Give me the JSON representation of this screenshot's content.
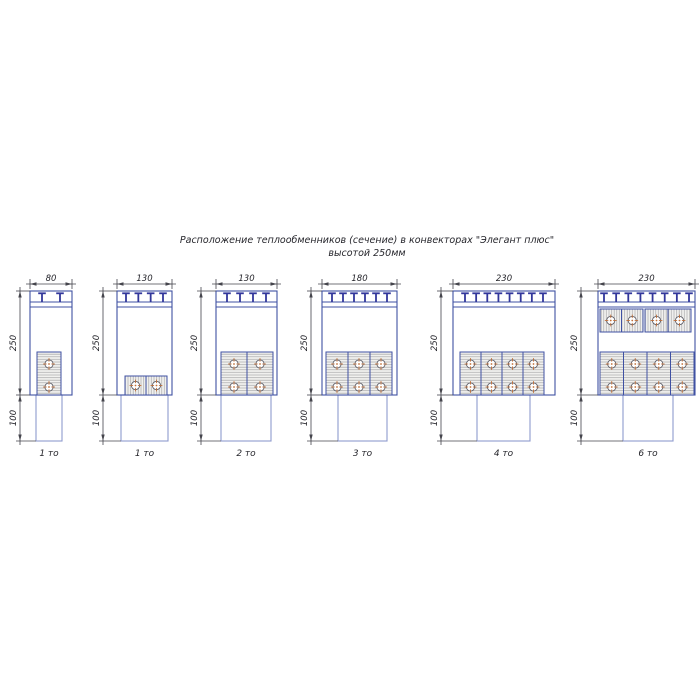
{
  "title": {
    "line1": "Расположение теплообменников (сечение) в конвекторах \"Элегант плюс\"",
    "line2": "высотой 250мм"
  },
  "dimensions": {
    "height": "250",
    "base": "100"
  },
  "convectors": [
    {
      "width": "80",
      "label": "1 то",
      "clips": 2,
      "vertical_exchangers": 1,
      "horizontal_exchangers": 0,
      "tubes": 2
    },
    {
      "width": "130",
      "label": "1 то",
      "clips": 4,
      "vertical_exchangers": 0,
      "horizontal_exchangers": 1,
      "tubes": 2
    },
    {
      "width": "130",
      "label": "2 то",
      "clips": 4,
      "vertical_exchangers": 2,
      "horizontal_exchangers": 0,
      "tubes": 4
    },
    {
      "width": "180",
      "label": "3 то",
      "clips": 6,
      "vertical_exchangers": 3,
      "horizontal_exchangers": 0,
      "tubes": 6
    },
    {
      "width": "230",
      "label": "4 то",
      "clips": 8,
      "vertical_exchangers": 4,
      "horizontal_exchangers": 0,
      "tubes": 8
    },
    {
      "width": "230",
      "label": "6 то",
      "clips": 8,
      "vertical_exchangers": 4,
      "horizontal_exchangers": 2,
      "tubes": 12
    }
  ],
  "colors": {
    "outline": "#3f51a3",
    "outline_light": "#8e9ace",
    "clip": "#32379b",
    "hatch_line": "#a9a9a9",
    "hatch_bg": "#f1f1ef",
    "tube_stroke": "#5a5a64",
    "tube_cross": "#c0703a",
    "dim": "#44444c",
    "text": "#26262c"
  }
}
